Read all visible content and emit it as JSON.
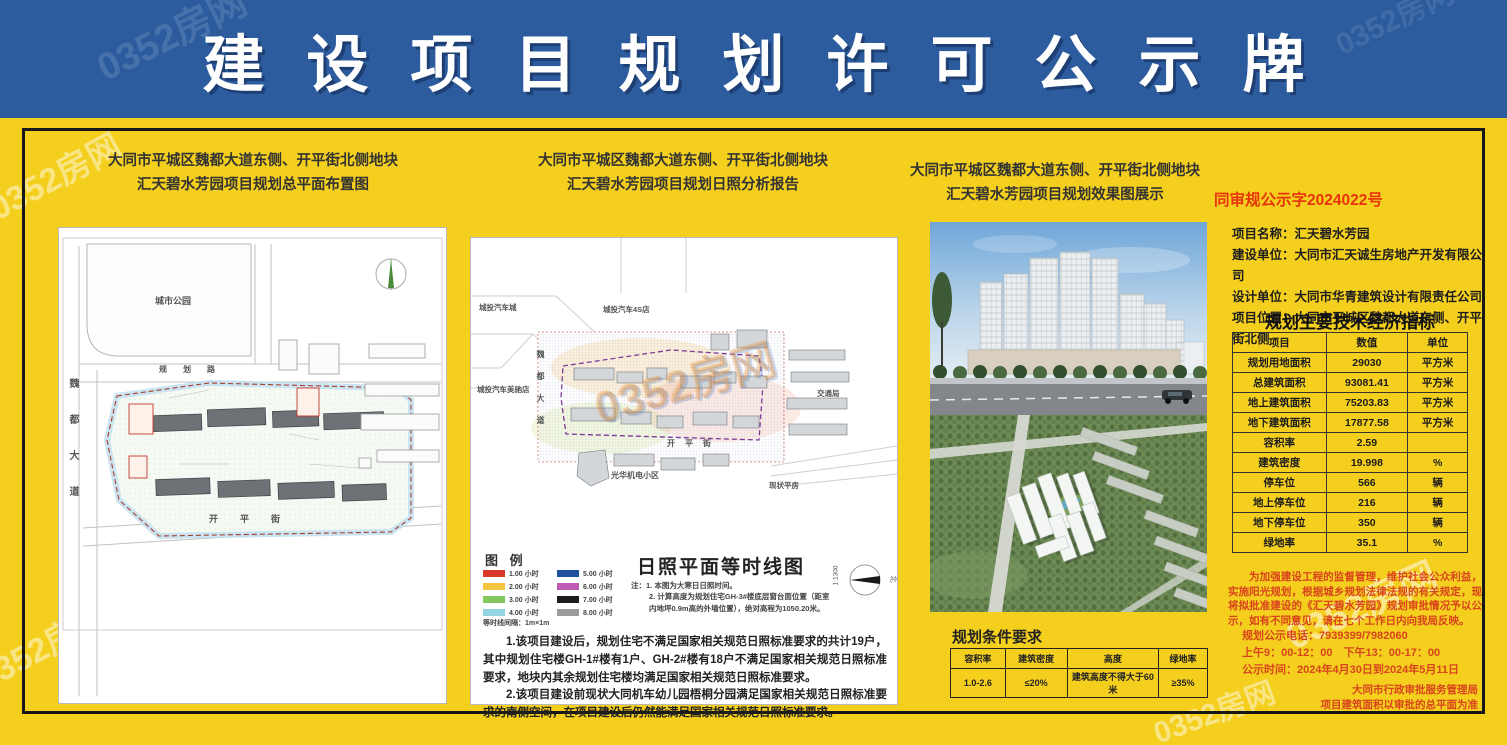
{
  "watermark": "0352房网",
  "colors": {
    "header_bg": "#2c5c9e",
    "body_bg": "#f4cf1e",
    "frame": "#171717",
    "doc_number_red": "#e8330a",
    "notice_red": "#d8441c"
  },
  "header": {
    "title": "建设项目规划许可公示牌"
  },
  "left_panel": {
    "title1": "大同市平城区魏都大道东侧、开平街北侧地块",
    "title2": "汇天碧水芳园项目规划总平面布置图",
    "labels": {
      "park": "城市公园",
      "road_top": "规划路",
      "road_left": "魏都大道",
      "road_bottom": "开平街"
    }
  },
  "middle_panel": {
    "title1": "大同市平城区魏都大道东侧、开平街北侧地块",
    "title2": "汇天碧水芳园项目规划日照分析报告",
    "labels": {
      "auto_city": "城投汽车城",
      "auto_4s": "城投汽车4S店",
      "auto_shop": "城投汽车美驰店",
      "road_left": "魏都大道",
      "road_bottom": "开平街",
      "estate": "光华机电小区",
      "bureau": "交通局",
      "houses": "现状平房"
    },
    "legend": {
      "title": "图 例",
      "items": [
        {
          "color": "#d93a2b",
          "label": "1.00 小时"
        },
        {
          "color": "#f2c53d",
          "label": "2.00 小时"
        },
        {
          "color": "#84c75d",
          "label": "3.00 小时"
        },
        {
          "color": "#93d6e2",
          "label": "4.00 小时"
        },
        {
          "color": "#20509e",
          "label": "5.00 小时"
        },
        {
          "color": "#bf5db4",
          "label": "6.00 小时"
        },
        {
          "color": "#1c1c1c",
          "label": "7.00 小时"
        },
        {
          "color": "#9c9c9c",
          "label": "8.00 小时"
        }
      ],
      "note": "等时线间隔：1m×1m"
    },
    "diagram_title": "日照平面等时线图",
    "diagram_note1": "注：1. 本图为大寒日日照时间。",
    "diagram_note2": "2. 计算高度为规划住宅GH-3#楼底层窗台面位置（距室内地坪0.9m高的外墙位置），绝对高程为1050.20米。",
    "scale": "1:1300",
    "north": "北",
    "note1": "1.该项目建设后，规划住宅不满足国家相关规范日照标准要求的共计19户，其中规划住宅楼GH-1#楼有1户、GH-2#楼有18户不满足国家相关规范日照标准要求，地块内其余规划住宅楼均满足国家相关规范日照标准要求。",
    "note2": "2.该项目建设前现状大同机车幼儿园梧桐分园满足国家相关规范日照标准要求的南侧空间，在项目建设后仍然能满足国家相关规范日照标准要求。"
  },
  "right_panel": {
    "title1": "大同市平城区魏都大道东侧、开平街北侧地块",
    "title2": "汇天碧水芳园项目规划效果图展示",
    "doc_number": "同审规公示字2024022号",
    "project_info": [
      {
        "label": "项目名称：",
        "value": "汇天碧水芳园"
      },
      {
        "label": "建设单位：",
        "value": "大同市汇天诚生房地产开发有限公司"
      },
      {
        "label": "设计单位：",
        "value": "大同市华青建筑设计有限责任公司"
      },
      {
        "label": "项目位置：",
        "value": "大同市平城区魏都大道东侧、开平街北侧"
      }
    ],
    "conditions": {
      "title": "规划条件要求",
      "headers": [
        "容积率",
        "建筑密度",
        "高度",
        "绿地率"
      ],
      "row": [
        "1.0-2.6",
        "≤20%",
        "建筑高度不得大于60米",
        "≥35%"
      ]
    },
    "indicators": {
      "title": "规划主要技术经济指标",
      "headers": [
        "项目",
        "数值",
        "单位"
      ],
      "rows": [
        [
          "规划用地面积",
          "29030",
          "平方米"
        ],
        [
          "总建筑面积",
          "93081.41",
          "平方米"
        ],
        [
          "地上建筑面积",
          "75203.83",
          "平方米"
        ],
        [
          "地下建筑面积",
          "17877.58",
          "平方米"
        ],
        [
          "容积率",
          "2.59",
          ""
        ],
        [
          "建筑密度",
          "19.998",
          "%"
        ],
        [
          "停车位",
          "566",
          "辆"
        ],
        [
          "地上停车位",
          "216",
          "辆"
        ],
        [
          "地下停车位",
          "350",
          "辆"
        ],
        [
          "绿地率",
          "35.1",
          "%"
        ]
      ]
    },
    "notice": {
      "paragraph": "为加强建设工程的监督管理，维护社会公众利益，实施阳光规划，根据城乡规划法律法规的有关规定，现将拟批准建设的《汇天碧水芳园》规划审批情况予以公示，如有不同意见，请在七个工作日内向我局反映。",
      "phone": "规划公示电话：7939399/7982060",
      "hours": "上午9：00-12：00　下午13：00-17：00",
      "period": "公示时间：2024年4月30日到2024年5月11日",
      "agency": "大同市行政审批服务管理局",
      "footnote": "项目建筑面积以审批的总平面为准"
    }
  }
}
